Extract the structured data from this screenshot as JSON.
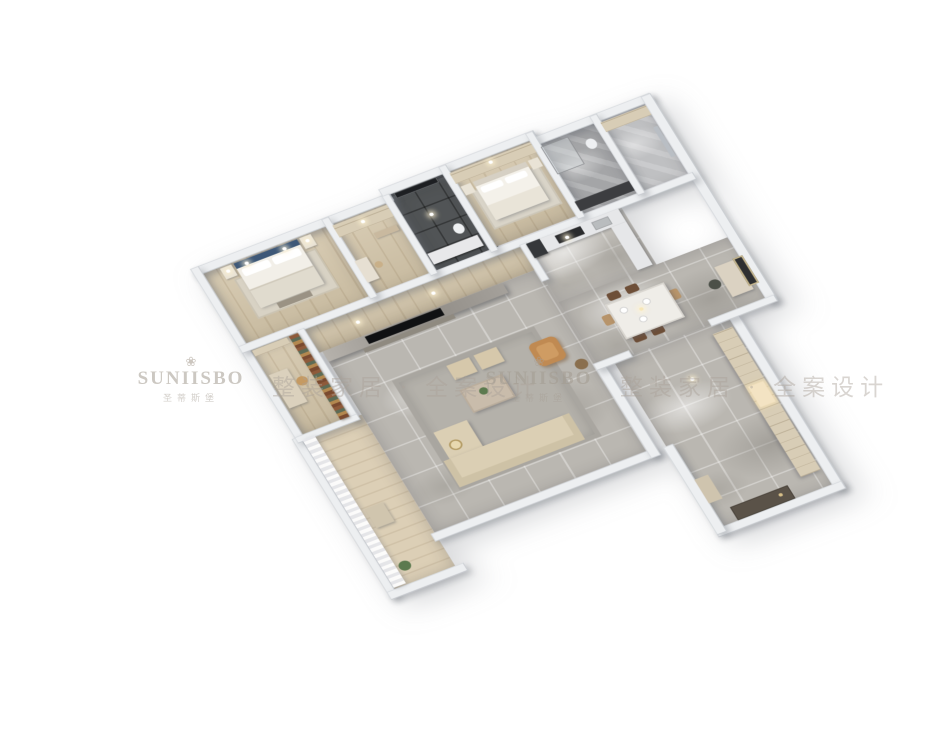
{
  "meta": {
    "type": "3d-floorplan-dollhouse-render",
    "background": "#ffffff",
    "view": "high-angle axonometric"
  },
  "watermark": {
    "flower_icon": "❀",
    "brand": "SUNIISBO",
    "brand_cn": "圣蒂斯堡",
    "tagline": "整装家居 · 全案设计"
  },
  "palette": {
    "outer_wall": "#edeff1",
    "wood_floor": "#d2c4a8",
    "marble_floor": "#bab7b1",
    "dark_bath": "#515456",
    "headboard_blue": "#3e5878",
    "sofa_beige": "#dbcfb4",
    "armchair_camel": "#c08a52",
    "cabinet_wood": "#d8cdb6",
    "tv_black": "#101113"
  },
  "scene": {
    "rooms": [
      "master-bedroom",
      "walk-in-closet",
      "dark-bathroom",
      "second-bedroom",
      "gray-bathroom",
      "laundry-room",
      "corridor",
      "study",
      "kitchen",
      "dining-area",
      "living-room",
      "balcony",
      "entry-hall"
    ],
    "furniture": [
      "double-bed-blue-headboard",
      "nightstands-with-lamps",
      "wardrobes",
      "second-bed",
      "vanity",
      "bookshelf",
      "desk",
      "kitchen-counter",
      "fridge",
      "dining-table-with-chairs",
      "desk-nook",
      "wall-art",
      "tv-feature-wall",
      "sectional-sofa",
      "coffee-table",
      "ottomans",
      "camel-armchair",
      "floor-lamp",
      "sheer-curtains",
      "entry-cabinets",
      "entry-door"
    ]
  }
}
